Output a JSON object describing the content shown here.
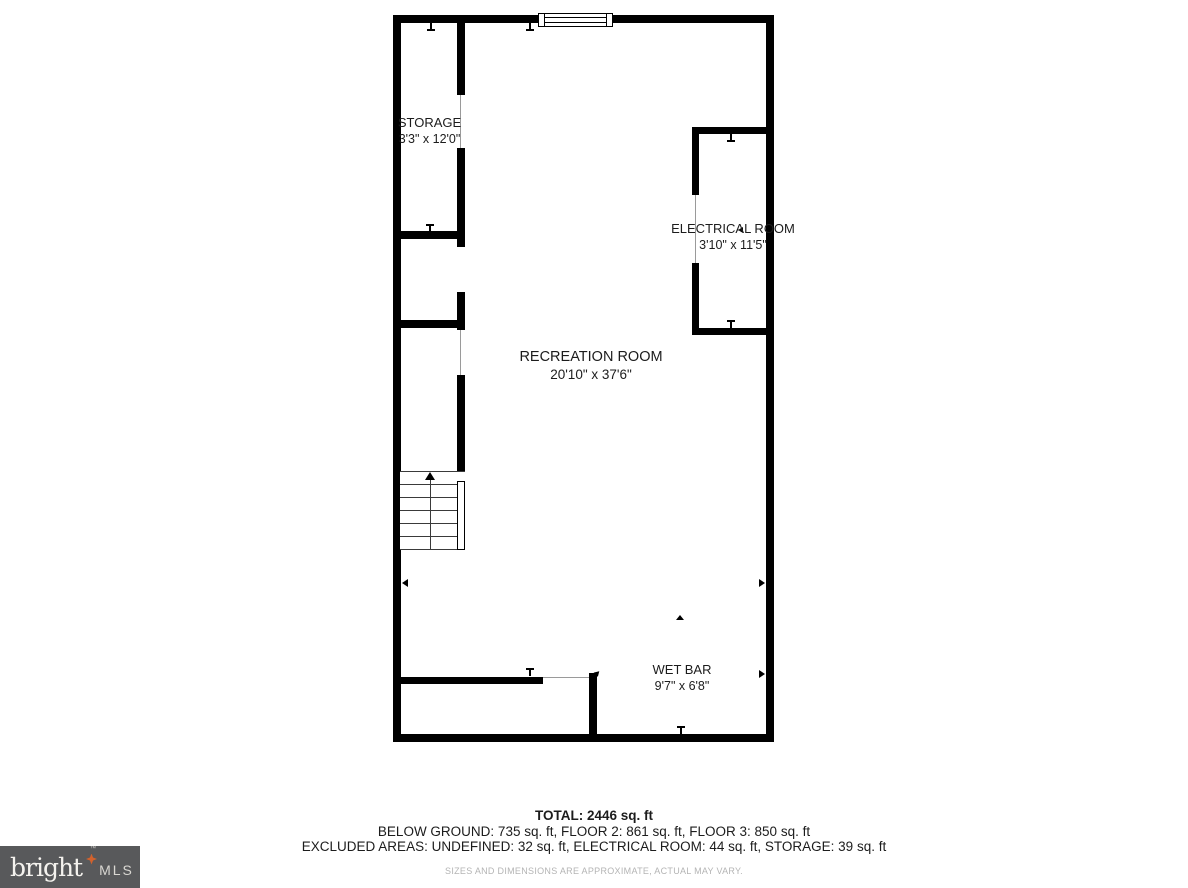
{
  "floor_plan": {
    "rooms": {
      "storage": {
        "name": "STORAGE",
        "dims": "3'3\" x 12'0\""
      },
      "electrical": {
        "name": "ELECTRICAL ROOM",
        "dims": "3'10\" x 11'5\""
      },
      "recreation": {
        "name": "RECREATION ROOM",
        "dims": "20'10\" x 37'6\""
      },
      "wet_bar": {
        "name": "WET BAR",
        "dims": "9'7\" x 6'8\""
      }
    },
    "colors": {
      "wall": "#000000",
      "background": "#ffffff"
    }
  },
  "summary": {
    "total": "TOTAL: 2446 sq. ft",
    "floors": "BELOW GROUND: 735 sq. ft, FLOOR 2: 861 sq. ft, FLOOR 3: 850 sq. ft",
    "excluded_areas": "EXCLUDED AREAS: UNDEFINED: 32 sq. ft, ELECTRICAL ROOM: 44 sq. ft, STORAGE: 39 sq. ft",
    "disclaimer": "SIZES AND DIMENSIONS ARE APPROXIMATE, ACTUAL MAY VARY."
  },
  "logo": {
    "brand": "bright",
    "trademark": "TM",
    "suffix": "MLS",
    "background": "#58595b",
    "star_color": "#d2622d"
  }
}
